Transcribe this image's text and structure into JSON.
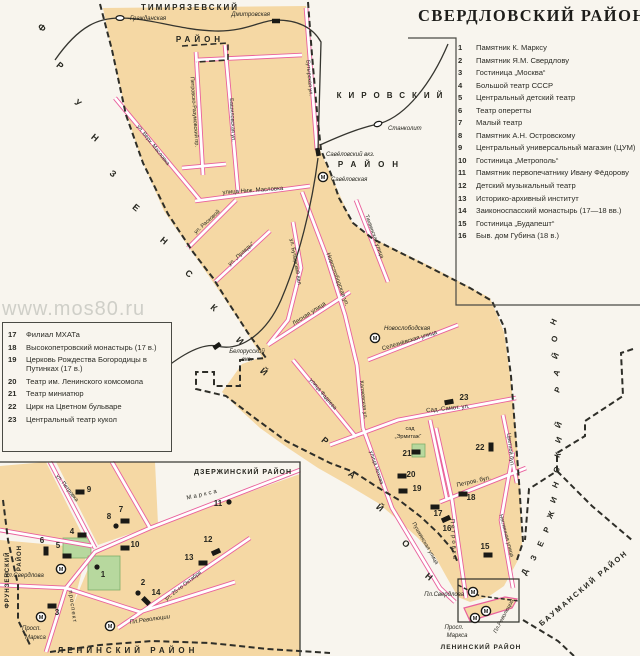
{
  "title": "СВЕРДЛОВСКИЙ РАЙОН",
  "watermark": "www.mos80.ru",
  "legend_right": {
    "items": [
      {
        "num": "1",
        "label": "Памятник К. Марксу"
      },
      {
        "num": "2",
        "label": "Памятник Я.М. Свердлову"
      },
      {
        "num": "3",
        "label": "Гостиница „Москва“"
      },
      {
        "num": "4",
        "label": "Большой театр СССР"
      },
      {
        "num": "5",
        "label": "Центральный детский театр"
      },
      {
        "num": "6",
        "label": "Театр оперетты"
      },
      {
        "num": "7",
        "label": "Малый театр"
      },
      {
        "num": "8",
        "label": "Памятник А.Н. Островскому"
      },
      {
        "num": "9",
        "label": "Центральный универсальный магазин (ЦУМ)"
      },
      {
        "num": "10",
        "label": "Гостиница „Метрополь“"
      },
      {
        "num": "11",
        "label": "Памятник первопечатнику Ивану Фёдорову"
      },
      {
        "num": "12",
        "label": "Детский музыкальный театр"
      },
      {
        "num": "13",
        "label": "Историко-архивный институт"
      },
      {
        "num": "14",
        "label": "Заиконоспасский монастырь (17—18 вв.)"
      },
      {
        "num": "15",
        "label": "Гостиница „Будапешт“"
      },
      {
        "num": "16",
        "label": "Быв. дом Губина (18 в.)"
      }
    ]
  },
  "legend_left": {
    "items": [
      {
        "num": "17",
        "label": "Филиал МХАТа"
      },
      {
        "num": "18",
        "label": "Высокопетровский монастырь (17 в.)"
      },
      {
        "num": "19",
        "label": "Церковь Рождества Богородицы в Путинках (17 в.)"
      },
      {
        "num": "20",
        "label": "Театр им. Ленинского комсомола"
      },
      {
        "num": "21",
        "label": "Театр миниатюр"
      },
      {
        "num": "22",
        "label": "Цирк на Цветном бульваре"
      },
      {
        "num": "23",
        "label": "Центральный театр кукол"
      }
    ]
  },
  "map": {
    "labels": [
      {
        "t": "ТИМИРЯЗЕВСКИЙ",
        "x": 190,
        "y": 10,
        "fs": 8,
        "b": 1,
        "ls": 2,
        "n": "district-label-timiryazevsky"
      },
      {
        "t": "РАЙОН",
        "x": 200,
        "y": 42,
        "fs": 8,
        "b": 1,
        "ls": 4,
        "n": "district-label-timiryazevsky-raion"
      },
      {
        "t": "КИРОВСКИЙ",
        "x": 393,
        "y": 98,
        "fs": 8,
        "b": 1,
        "ls": 7,
        "n": "district-label-kirovsky"
      },
      {
        "t": "РАЙОН",
        "x": 372,
        "y": 167,
        "fs": 8,
        "b": 1,
        "ls": 8,
        "n": "district-label-kirovsky-raion"
      },
      {
        "t": "Ф",
        "x": 40,
        "y": 30,
        "r": 40,
        "fs": 9,
        "b": 1
      },
      {
        "t": "Р",
        "x": 58,
        "y": 68,
        "r": 40,
        "fs": 9,
        "b": 1
      },
      {
        "t": "У",
        "x": 76,
        "y": 105,
        "r": 40,
        "fs": 9,
        "b": 1
      },
      {
        "t": "Н",
        "x": 93,
        "y": 140,
        "r": 40,
        "fs": 9,
        "b": 1
      },
      {
        "t": "З",
        "x": 111,
        "y": 176,
        "r": 40,
        "fs": 9,
        "b": 1
      },
      {
        "t": "Е",
        "x": 134,
        "y": 210,
        "r": 40,
        "fs": 9,
        "b": 1
      },
      {
        "t": "Н",
        "x": 162,
        "y": 243,
        "r": 40,
        "fs": 9,
        "b": 1
      },
      {
        "t": "С",
        "x": 187,
        "y": 276,
        "r": 40,
        "fs": 9,
        "b": 1
      },
      {
        "t": "К",
        "x": 212,
        "y": 310,
        "r": 40,
        "fs": 9,
        "b": 1
      },
      {
        "t": "И",
        "x": 238,
        "y": 343,
        "r": 40,
        "fs": 9,
        "b": 1
      },
      {
        "t": "Й",
        "x": 262,
        "y": 374,
        "r": 40,
        "fs": 9,
        "b": 1
      },
      {
        "t": "Р",
        "x": 323,
        "y": 443,
        "r": 40,
        "fs": 9,
        "b": 1
      },
      {
        "t": "А",
        "x": 350,
        "y": 477,
        "r": 40,
        "fs": 9,
        "b": 1
      },
      {
        "t": "Й",
        "x": 378,
        "y": 510,
        "r": 40,
        "fs": 9,
        "b": 1
      },
      {
        "t": "О",
        "x": 404,
        "y": 546,
        "r": 40,
        "fs": 9,
        "b": 1
      },
      {
        "t": "Н",
        "x": 427,
        "y": 579,
        "r": 40,
        "fs": 9,
        "b": 1
      },
      {
        "t": "Д",
        "x": 527,
        "y": 573,
        "r": -65,
        "fs": 8,
        "b": 1
      },
      {
        "t": "З",
        "x": 536,
        "y": 559,
        "r": -65,
        "fs": 8,
        "b": 1
      },
      {
        "t": "Е",
        "x": 543,
        "y": 545,
        "r": -65,
        "fs": 8,
        "b": 1
      },
      {
        "t": "Р",
        "x": 549,
        "y": 531,
        "r": -65,
        "fs": 8,
        "b": 1
      },
      {
        "t": "Ж",
        "x": 553,
        "y": 516,
        "r": -65,
        "fs": 8,
        "b": 1
      },
      {
        "t": "И",
        "x": 556,
        "y": 501,
        "r": -65,
        "fs": 8,
        "b": 1
      },
      {
        "t": "Н",
        "x": 558,
        "y": 486,
        "r": -65,
        "fs": 8,
        "b": 1
      },
      {
        "t": "С",
        "x": 559,
        "y": 471,
        "r": -65,
        "fs": 8,
        "b": 1
      },
      {
        "t": "К",
        "x": 560,
        "y": 456,
        "r": -65,
        "fs": 8,
        "b": 1
      },
      {
        "t": "И",
        "x": 561,
        "y": 441,
        "r": -65,
        "fs": 8,
        "b": 1
      },
      {
        "t": "Й",
        "x": 561,
        "y": 426,
        "r": -65,
        "fs": 8,
        "b": 1
      },
      {
        "t": "Р",
        "x": 560,
        "y": 391,
        "r": -65,
        "fs": 8,
        "b": 1
      },
      {
        "t": "А",
        "x": 559,
        "y": 374,
        "r": -65,
        "fs": 8,
        "b": 1
      },
      {
        "t": "Й",
        "x": 558,
        "y": 357,
        "r": -65,
        "fs": 8,
        "b": 1
      },
      {
        "t": "О",
        "x": 557,
        "y": 340,
        "r": -65,
        "fs": 8,
        "b": 1
      },
      {
        "t": "Н",
        "x": 556,
        "y": 323,
        "r": -65,
        "fs": 8,
        "b": 1
      },
      {
        "t": "БАУМАНСКИЙ  РАЙОН",
        "x": 585,
        "y": 590,
        "r": -40,
        "fs": 7.5,
        "b": 1,
        "ls": 2,
        "n": "district-label-baumansky"
      },
      {
        "t": "ЛЕНИНСКИЙ РАЙОН",
        "x": 481,
        "y": 649,
        "fs": 6.5,
        "b": 1,
        "ls": 1,
        "n": "district-label-leninsky-small"
      },
      {
        "t": "ЛЕНИНСКИЙ  РАЙОН",
        "x": 128,
        "y": 653,
        "fs": 8,
        "b": 1,
        "ls": 4,
        "n": "district-label-leninsky"
      },
      {
        "t": "ДЗЕРЖИНСКИЙ  РАЙОН",
        "x": 243,
        "y": 474,
        "fs": 7,
        "b": 1,
        "ls": 1,
        "n": "district-label-dzerzhinsky-inset"
      },
      {
        "t": "ФРУНЗЕНСКИЙ",
        "x": 9,
        "y": 580,
        "r": -90,
        "fs": 6,
        "b": 1,
        "ls": 1,
        "n": "district-label-frunzensky-inset"
      },
      {
        "t": "РАЙОН",
        "x": 21,
        "y": 558,
        "r": -90,
        "fs": 6,
        "b": 1,
        "ls": 1
      },
      {
        "t": "Петровско-Разумовский пр.",
        "x": 193,
        "y": 112,
        "r": 86,
        "fs": 5.5
      },
      {
        "t": "Башиловская ул.",
        "x": 231,
        "y": 120,
        "r": 87,
        "fs": 5.5
      },
      {
        "t": "Бутырская ул.",
        "x": 308,
        "y": 78,
        "r": 85,
        "fs": 5.5
      },
      {
        "t": "ул. Верх. Масловка",
        "x": 152,
        "y": 146,
        "r": 52,
        "fs": 5.5
      },
      {
        "t": "улица Ниж. Масловка",
        "x": 253,
        "y": 192,
        "r": -4,
        "fs": 6
      },
      {
        "t": "ул. Расковой",
        "x": 208,
        "y": 223,
        "r": -42,
        "fs": 5.5
      },
      {
        "t": "ул. „Правды“",
        "x": 242,
        "y": 255,
        "r": -42,
        "fs": 5.5
      },
      {
        "t": "Новослободская ул.",
        "x": 336,
        "y": 280,
        "r": 70,
        "fs": 6
      },
      {
        "t": "Каляевская ул.",
        "x": 362,
        "y": 400,
        "r": 84,
        "fs": 5.5
      },
      {
        "t": "ул. Бутырский вал",
        "x": 294,
        "y": 262,
        "r": 80,
        "fs": 5.5
      },
      {
        "t": "Лесная улица",
        "x": 310,
        "y": 315,
        "r": -33,
        "fs": 6
      },
      {
        "t": "Тихвинская улица",
        "x": 373,
        "y": 237,
        "r": 70,
        "fs": 5.5
      },
      {
        "t": "улица Фадеева",
        "x": 322,
        "y": 395,
        "r": 50,
        "fs": 5.5
      },
      {
        "t": "Селезнёвская улица",
        "x": 410,
        "y": 342,
        "r": -17,
        "fs": 6
      },
      {
        "t": "Сад.-Самот. ул.",
        "x": 448,
        "y": 410,
        "r": -6,
        "fs": 6
      },
      {
        "t": "Цветной бул.",
        "x": 509,
        "y": 450,
        "r": 84,
        "fs": 5.5
      },
      {
        "t": "Петров. бул.",
        "x": 474,
        "y": 483,
        "r": -13,
        "fs": 6
      },
      {
        "t": "Неглинная улица",
        "x": 505,
        "y": 536,
        "r": 75,
        "fs": 5.5
      },
      {
        "t": "Петровка",
        "x": 452,
        "y": 540,
        "r": 86,
        "fs": 6,
        "ls": 2
      },
      {
        "t": "Пушкинская улица",
        "x": 424,
        "y": 544,
        "r": 60,
        "fs": 5.5
      },
      {
        "t": "улица Чехова",
        "x": 375,
        "y": 468,
        "r": 72,
        "fs": 5.5
      },
      {
        "t": "сад",
        "x": 410,
        "y": 430,
        "fs": 5.5
      },
      {
        "t": "„Эрмитаж“",
        "x": 408,
        "y": 438,
        "fs": 5.5
      },
      {
        "t": "Гражданская",
        "x": 130,
        "y": 20,
        "it": 1,
        "a": "start",
        "n": "station-label"
      },
      {
        "t": "Дмитровская",
        "x": 270,
        "y": 16,
        "it": 1,
        "a": "end",
        "n": "station-label"
      },
      {
        "t": "Станколит",
        "x": 388,
        "y": 130,
        "it": 1,
        "a": "start",
        "n": "station-label"
      },
      {
        "t": "Савёловский вкз.",
        "x": 326,
        "y": 156,
        "it": 1,
        "a": "start",
        "n": "station-label"
      },
      {
        "t": "Савёловская",
        "x": 331,
        "y": 181,
        "it": 1,
        "a": "start",
        "n": "metro-label"
      },
      {
        "t": "Белорусский",
        "x": 247,
        "y": 353,
        "it": 1,
        "n": "station-label"
      },
      {
        "t": "вкз.",
        "x": 247,
        "y": 361,
        "it": 1
      },
      {
        "t": "Новослободская",
        "x": 384,
        "y": 330,
        "it": 1,
        "a": "start",
        "n": "metro-label"
      },
      {
        "t": "Пл.Свердлова",
        "x": 464,
        "y": 596,
        "it": 1,
        "a": "end"
      },
      {
        "t": "Пл.Революции",
        "x": 505,
        "y": 617,
        "r": -62,
        "it": 1,
        "fs": 5.5
      },
      {
        "t": "Просп.",
        "x": 454,
        "y": 629,
        "it": 1
      },
      {
        "t": "Маркса",
        "x": 457,
        "y": 637,
        "it": 1
      },
      {
        "t": "ул. Петровка",
        "x": 66,
        "y": 489,
        "r": 52,
        "fs": 5.5
      },
      {
        "t": "Маркса",
        "x": 203,
        "y": 496,
        "r": -13,
        "fs": 6,
        "ls": 2
      },
      {
        "t": "проспект",
        "x": 71,
        "y": 607,
        "r": 82,
        "fs": 6,
        "ls": 1
      },
      {
        "t": "ул. 25-го Октября",
        "x": 184,
        "y": 587,
        "r": -38,
        "fs": 5.5
      },
      {
        "t": "Пл.Свердлова",
        "x": 4,
        "y": 577,
        "it": 1,
        "a": "start"
      },
      {
        "t": "Пл.Революции",
        "x": 150,
        "y": 621,
        "r": -8,
        "it": 1
      },
      {
        "t": "Просп.",
        "x": 22,
        "y": 630,
        "it": 1,
        "a": "start"
      },
      {
        "t": "Маркса",
        "x": 25,
        "y": 639,
        "it": 1,
        "a": "start"
      },
      {
        "t": "15",
        "x": 485,
        "y": 549,
        "b": 1,
        "fs": 8,
        "n": "map-number"
      },
      {
        "t": "16",
        "x": 447,
        "y": 531,
        "b": 1,
        "fs": 8,
        "n": "map-number"
      },
      {
        "t": "17",
        "x": 438,
        "y": 516,
        "b": 1,
        "fs": 8,
        "n": "map-number"
      },
      {
        "t": "18",
        "x": 471,
        "y": 500,
        "b": 1,
        "fs": 8,
        "n": "map-number"
      },
      {
        "t": "19",
        "x": 417,
        "y": 491,
        "b": 1,
        "fs": 8,
        "n": "map-number"
      },
      {
        "t": "20",
        "x": 411,
        "y": 477,
        "b": 1,
        "fs": 8,
        "n": "map-number"
      },
      {
        "t": "21",
        "x": 407,
        "y": 456,
        "b": 1,
        "fs": 8,
        "n": "map-number"
      },
      {
        "t": "22",
        "x": 480,
        "y": 450,
        "b": 1,
        "fs": 8,
        "n": "map-number"
      },
      {
        "t": "23",
        "x": 464,
        "y": 400,
        "b": 1,
        "fs": 8,
        "n": "map-number"
      },
      {
        "t": "1",
        "x": 103,
        "y": 577,
        "b": 1,
        "fs": 8,
        "n": "map-number"
      },
      {
        "t": "2",
        "x": 143,
        "y": 585,
        "b": 1,
        "fs": 8,
        "n": "map-number"
      },
      {
        "t": "3",
        "x": 57,
        "y": 615,
        "b": 1,
        "fs": 8,
        "n": "map-number"
      },
      {
        "t": "4",
        "x": 72,
        "y": 534,
        "b": 1,
        "fs": 8,
        "n": "map-number"
      },
      {
        "t": "5",
        "x": 58,
        "y": 548,
        "b": 1,
        "fs": 8,
        "n": "map-number"
      },
      {
        "t": "6",
        "x": 42,
        "y": 543,
        "b": 1,
        "fs": 8,
        "n": "map-number"
      },
      {
        "t": "7",
        "x": 121,
        "y": 512,
        "b": 1,
        "fs": 8,
        "n": "map-number"
      },
      {
        "t": "8",
        "x": 109,
        "y": 519,
        "b": 1,
        "fs": 8,
        "n": "map-number"
      },
      {
        "t": "9",
        "x": 89,
        "y": 492,
        "b": 1,
        "fs": 8,
        "n": "map-number"
      },
      {
        "t": "10",
        "x": 135,
        "y": 547,
        "b": 1,
        "fs": 8,
        "n": "map-number"
      },
      {
        "t": "11",
        "x": 218,
        "y": 506,
        "b": 1,
        "fs": 8,
        "n": "map-number"
      },
      {
        "t": "12",
        "x": 208,
        "y": 542,
        "b": 1,
        "fs": 8,
        "n": "map-number"
      },
      {
        "t": "13",
        "x": 189,
        "y": 560,
        "b": 1,
        "fs": 8,
        "n": "map-number"
      },
      {
        "t": "14",
        "x": 156,
        "y": 595,
        "b": 1,
        "fs": 8,
        "n": "map-number"
      }
    ],
    "markers": [
      {
        "k": "oval",
        "x": 120,
        "y": 18,
        "n": "station-grazhdanskaya"
      },
      {
        "k": "oval",
        "x": 378,
        "y": 124,
        "r": -20,
        "n": "station-stankolit"
      },
      {
        "k": "strect",
        "x": 276,
        "y": 21,
        "n": "station-dmitrovskaya"
      },
      {
        "k": "strect",
        "x": 318,
        "y": 152,
        "r": 80,
        "n": "station-savyolovsky"
      },
      {
        "k": "strect",
        "x": 217,
        "y": 346,
        "r": -35,
        "n": "station-belorussky"
      },
      {
        "k": "metro",
        "x": 323,
        "y": 177,
        "n": "metro-savyolovskaya"
      },
      {
        "k": "metro",
        "x": 375,
        "y": 338,
        "n": "metro-novoslobodskaya"
      },
      {
        "k": "metro",
        "x": 473,
        "y": 592,
        "n": "metro-pl-sverdlova"
      },
      {
        "k": "metro",
        "x": 486,
        "y": 611,
        "n": "metro-pl-revolyutsii"
      },
      {
        "k": "metro",
        "x": 475,
        "y": 618,
        "n": "metro-pl-revolyutsii-2"
      },
      {
        "k": "metro",
        "x": 61,
        "y": 569,
        "n": "metro-inset"
      },
      {
        "k": "metro",
        "x": 41,
        "y": 617,
        "n": "metro-inset"
      },
      {
        "k": "metro",
        "x": 110,
        "y": 626,
        "n": "metro-inset"
      },
      {
        "k": "rect",
        "x": 449,
        "y": 402,
        "r": -10
      },
      {
        "k": "rect",
        "x": 491,
        "y": 447,
        "r": 90
      },
      {
        "k": "rect",
        "x": 402,
        "y": 476
      },
      {
        "k": "rect",
        "x": 403,
        "y": 491
      },
      {
        "k": "rect",
        "x": 463,
        "y": 494
      },
      {
        "k": "rect",
        "x": 435,
        "y": 507
      },
      {
        "k": "rect",
        "x": 446,
        "y": 519,
        "r": -25
      },
      {
        "k": "rect",
        "x": 488,
        "y": 555
      },
      {
        "k": "rect",
        "x": 80,
        "y": 492
      },
      {
        "k": "rect",
        "x": 125,
        "y": 521
      },
      {
        "k": "rect",
        "x": 82,
        "y": 535
      },
      {
        "k": "rect",
        "x": 46,
        "y": 551,
        "r": 90
      },
      {
        "k": "rect",
        "x": 67,
        "y": 556
      },
      {
        "k": "rect",
        "x": 125,
        "y": 548
      },
      {
        "k": "rect",
        "x": 146,
        "y": 601,
        "r": 45
      },
      {
        "k": "rect",
        "x": 52,
        "y": 606
      },
      {
        "k": "rect",
        "x": 216,
        "y": 552,
        "r": -25
      },
      {
        "k": "rect",
        "x": 203,
        "y": 563
      },
      {
        "k": "rect",
        "x": 416,
        "y": 452
      },
      {
        "k": "dot",
        "x": 116,
        "y": 526
      },
      {
        "k": "dot",
        "x": 97,
        "y": 567
      },
      {
        "k": "dot",
        "x": 138,
        "y": 593
      },
      {
        "k": "dot",
        "x": 229,
        "y": 502
      }
    ]
  },
  "colors": {
    "paper": "#f8f5ee",
    "block_orange": "#f5d8a4",
    "street_pink": "#e9609c",
    "park_green": "#b7d89e",
    "ink": "#26261f"
  }
}
